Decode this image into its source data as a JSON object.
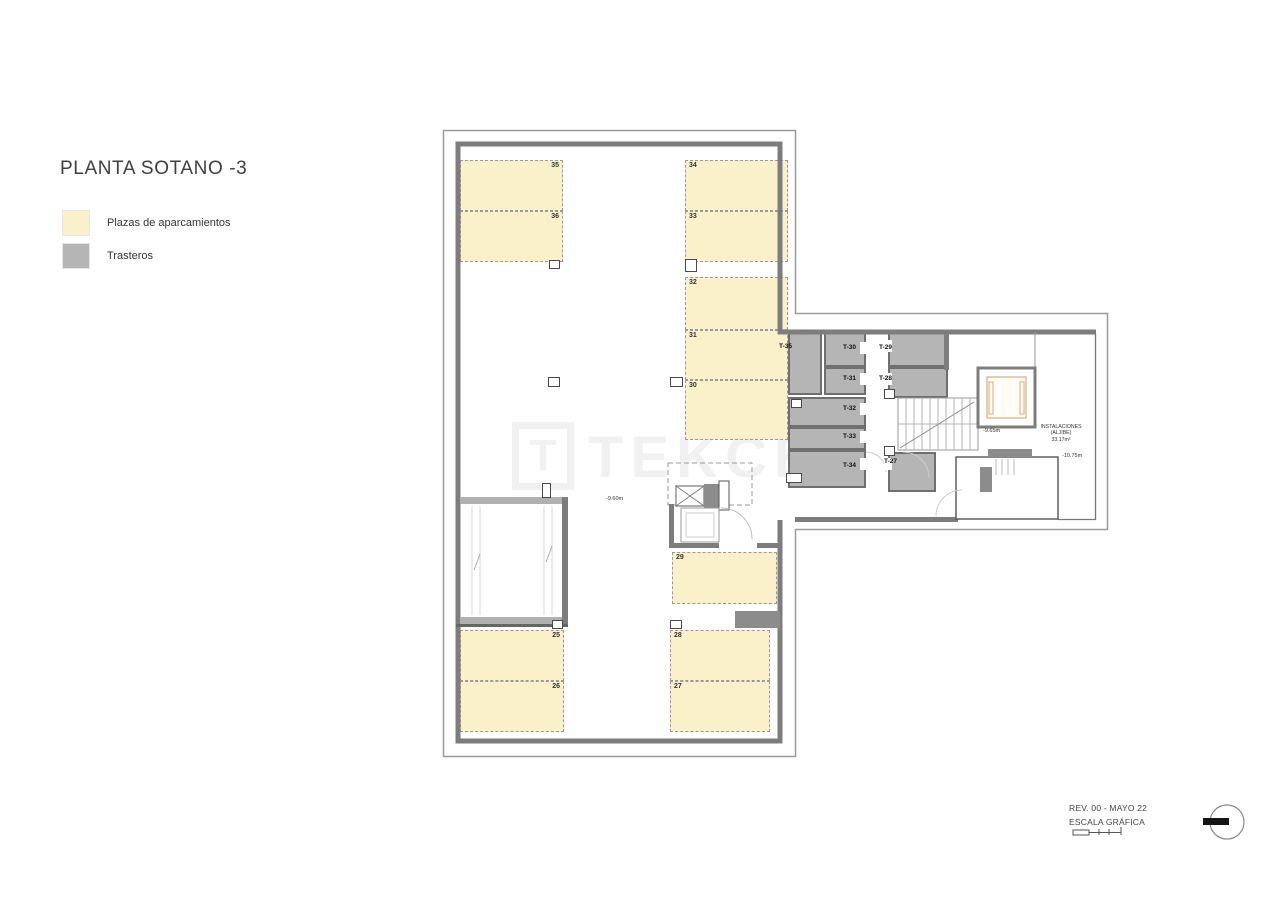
{
  "title": "PLANTA SOTANO -3",
  "legend": {
    "items": [
      {
        "label": "Plazas de aparcamientos",
        "color": "#FAF0C9"
      },
      {
        "label": "Trasteros",
        "color": "#B5B5B5"
      }
    ]
  },
  "watermark": {
    "logo_letter": "T",
    "text": "TEKCE"
  },
  "plan": {
    "parking": [
      {
        "id": "35"
      },
      {
        "id": "36"
      },
      {
        "id": "34"
      },
      {
        "id": "33"
      },
      {
        "id": "32"
      },
      {
        "id": "31"
      },
      {
        "id": "30"
      },
      {
        "id": "29"
      },
      {
        "id": "25"
      },
      {
        "id": "26"
      },
      {
        "id": "28"
      },
      {
        "id": "27"
      }
    ],
    "storage": [
      {
        "id": "T-35"
      },
      {
        "id": "T-30"
      },
      {
        "id": "T-31"
      },
      {
        "id": "T-32"
      },
      {
        "id": "T-33"
      },
      {
        "id": "T-34"
      },
      {
        "id": "T-29"
      },
      {
        "id": "T-28"
      },
      {
        "id": "T-27"
      }
    ],
    "levels": {
      "main": "-9.60m",
      "lift": "-9.65m",
      "right": "-10.75m"
    },
    "instalaciones": {
      "line1": "INSTALACIONES",
      "line2": "(ALJIBE)",
      "line3": "33.17m²"
    }
  },
  "footer": {
    "revision": "REV. 00 - MAYO 22",
    "scale_label": "ESCALA GRÁFICA"
  }
}
